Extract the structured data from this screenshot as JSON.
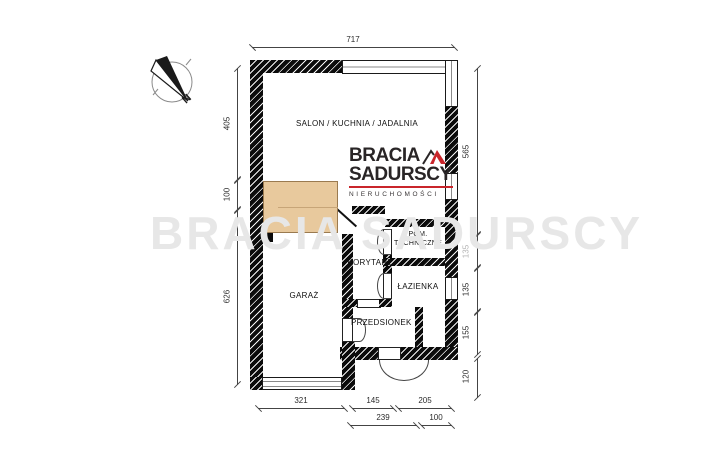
{
  "compass": {
    "label": "N"
  },
  "watermark": {
    "text": "BRACIA SADURSCY"
  },
  "logo": {
    "line1": "BRACIA",
    "line2": "SADURSCY",
    "line3": "NIERUCHOMOŚCI"
  },
  "rooms": {
    "salon": "SALON / KUCHNIA / JADALNIA",
    "garaz": "GARAŻ",
    "korytarz": "KORYTARZ",
    "pom_techniczne": "POM. TECHNICZNE",
    "lazienka": "ŁAZIENKA",
    "przedsionek": "PRZEDSIONEK"
  },
  "dimensions": {
    "top": "717",
    "left": [
      "405",
      "100",
      "626"
    ],
    "right": [
      "565",
      "135",
      "135",
      "155",
      "120"
    ],
    "bottom_row1": [
      "321",
      "145",
      "205"
    ],
    "bottom_row2": [
      "239",
      "100"
    ]
  },
  "colors": {
    "wall": "#0b0b0b",
    "stairs_fill": "#e8c99d",
    "brand_red": "#c9252b",
    "watermark": "#e7e7e7"
  }
}
